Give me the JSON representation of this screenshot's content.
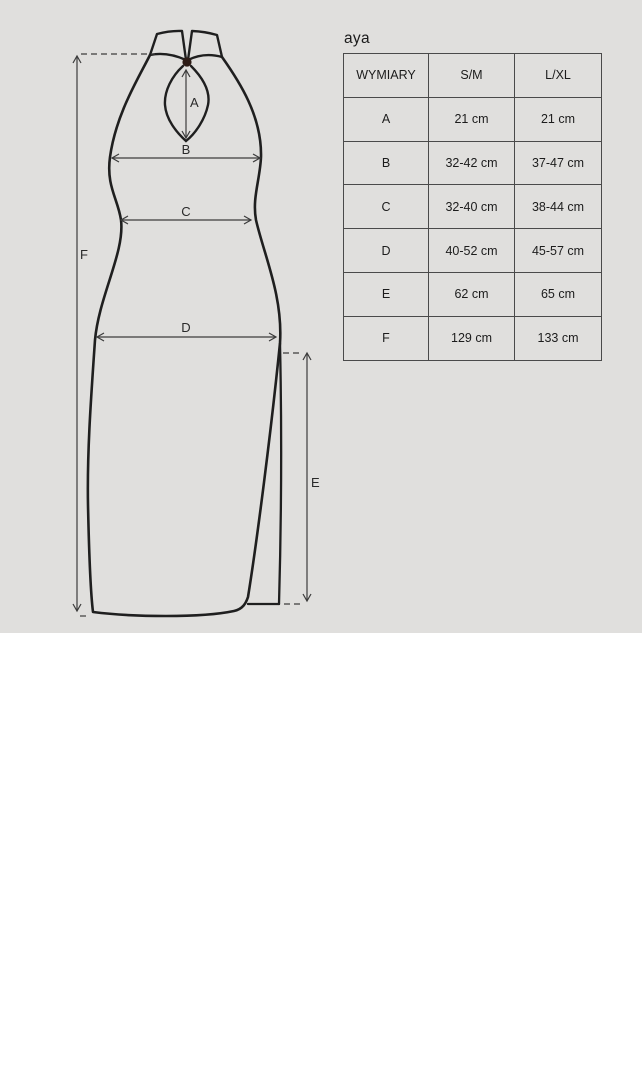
{
  "product": {
    "name": "aya"
  },
  "diagram": {
    "type": "garment-measurement-drawing",
    "garment": "halter-neck dress with keyhole neckline, collar with button, side slit",
    "labels": {
      "A": "A",
      "B": "B",
      "C": "C",
      "D": "D",
      "E": "E",
      "F": "F"
    }
  },
  "table": {
    "headers": [
      "WYMIARY",
      "S/M",
      "L/XL"
    ],
    "rows": [
      {
        "dim": "A",
        "sm": "21 cm",
        "lxl": "21 cm"
      },
      {
        "dim": "B",
        "sm": "32-42 cm",
        "lxl": "37-47 cm"
      },
      {
        "dim": "C",
        "sm": "32-40 cm",
        "lxl": "38-44 cm"
      },
      {
        "dim": "D",
        "sm": "40-52 cm",
        "lxl": "45-57 cm"
      },
      {
        "dim": "E",
        "sm": "62 cm",
        "lxl": "65 cm"
      },
      {
        "dim": "F",
        "sm": "129 cm",
        "lxl": "133 cm"
      }
    ]
  },
  "colors": {
    "panel_background": "#e0dfdd",
    "page_background": "#ffffff",
    "outline": "#1f1f1f",
    "measure_line": "#3c3c3c",
    "table_border": "#4a4a4a",
    "text": "#1c1c1c",
    "collar_button": "#2d1c16"
  }
}
